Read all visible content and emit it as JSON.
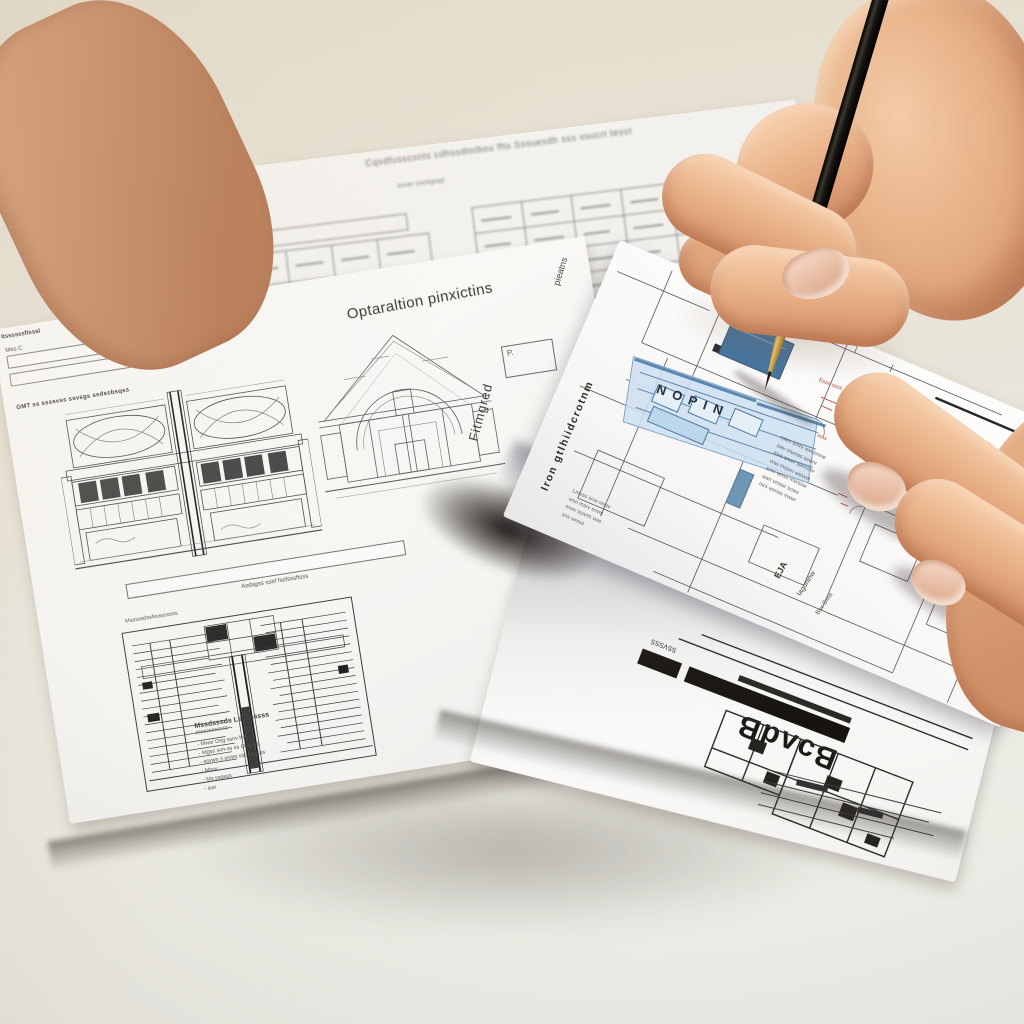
{
  "scene": {
    "description": "Two hands over overlapping architectural floor-plan printouts on a desk; the right hand holds a black pen with a brass nib pointing at a blue-highlighted room on the front sheet, while the left hand's fingers press the paper.",
    "colors": {
      "background_top": "#e6dfd0",
      "background_bottom": "#edece7",
      "paper": "#fbfaf8",
      "line_ink": "#4c4c4c",
      "highlight_blue_dark": "#47759d",
      "highlight_blue_light": "#cfe2ef",
      "annotation_red": "#b2392c",
      "pen_black": "#16140f",
      "pen_gold": "#b98f3e",
      "skin": "#e4a97f",
      "nail": "#ecc9b6",
      "shadow": "#4a443c"
    },
    "objects": {
      "pen": "black-pen-with-gold-nib",
      "right_hand": "hand-holding-pen",
      "left_hand": "hand-pressing-paper"
    }
  },
  "paper_top": {
    "heading": "Cqsdfusscsnts cdhssdtstbou ffts Sssuesdh sss ssucrt tesst",
    "subheading": "bsser ssvrkgsqd"
  },
  "paper_left": {
    "corner_note": "Itssssssftssal",
    "form_label": "Mes C",
    "stamp": "GMT ss ssssvss ssvsgs ssdssbsqss",
    "title": "Optaraltion pinxictins",
    "title_right_rotated": "pieatns",
    "plan_p_label": "P.",
    "elevation_caption": "Asdsgss ssef fssfsssftsss",
    "section_caption": "Msssssdssfsssssssss",
    "vertical_label": "Fitmgred",
    "bottom_heading": "Mssdsssds Lsqssssss",
    "bottom_sub": "ssssssssssss",
    "list_items": [
      "-   Mwsr Osg ssnv fnr",
      "-   Mgss svn-ss ss Osqsgs",
      "-   ssvwn s ssnm ssqsss sss",
      "-   Mssv",
      "-   Ms ssqsss",
      "-   svn"
    ]
  },
  "paper_front": {
    "vertical_label": "Iron gtlhiidcrotnm",
    "room_label": "NOPIN",
    "red_note1": "Essc ssss",
    "red_note2": "ssss",
    "notes1": [
      "nwm smrv vwssmne",
      "swv mwnss svwnr",
      "mvs snwv swmssv",
      "vnw mssrn wssvm",
      "smv wnss mvrssw",
      "wsn vmssr snwv",
      "mrs wvnss mswr"
    ],
    "notes2": [
      "Lmvss snw mssv",
      "wsn msrv snws",
      "mvw ssnrm vws",
      "snv wmss"
    ],
    "corner_label1": "EJA",
    "corner_label2": "Iagoninw",
    "corner_label3": "Bsv Gsss"
  },
  "paper_bottom": {
    "bold_label": "BɔʌdB",
    "side_note": "ssvsss"
  }
}
